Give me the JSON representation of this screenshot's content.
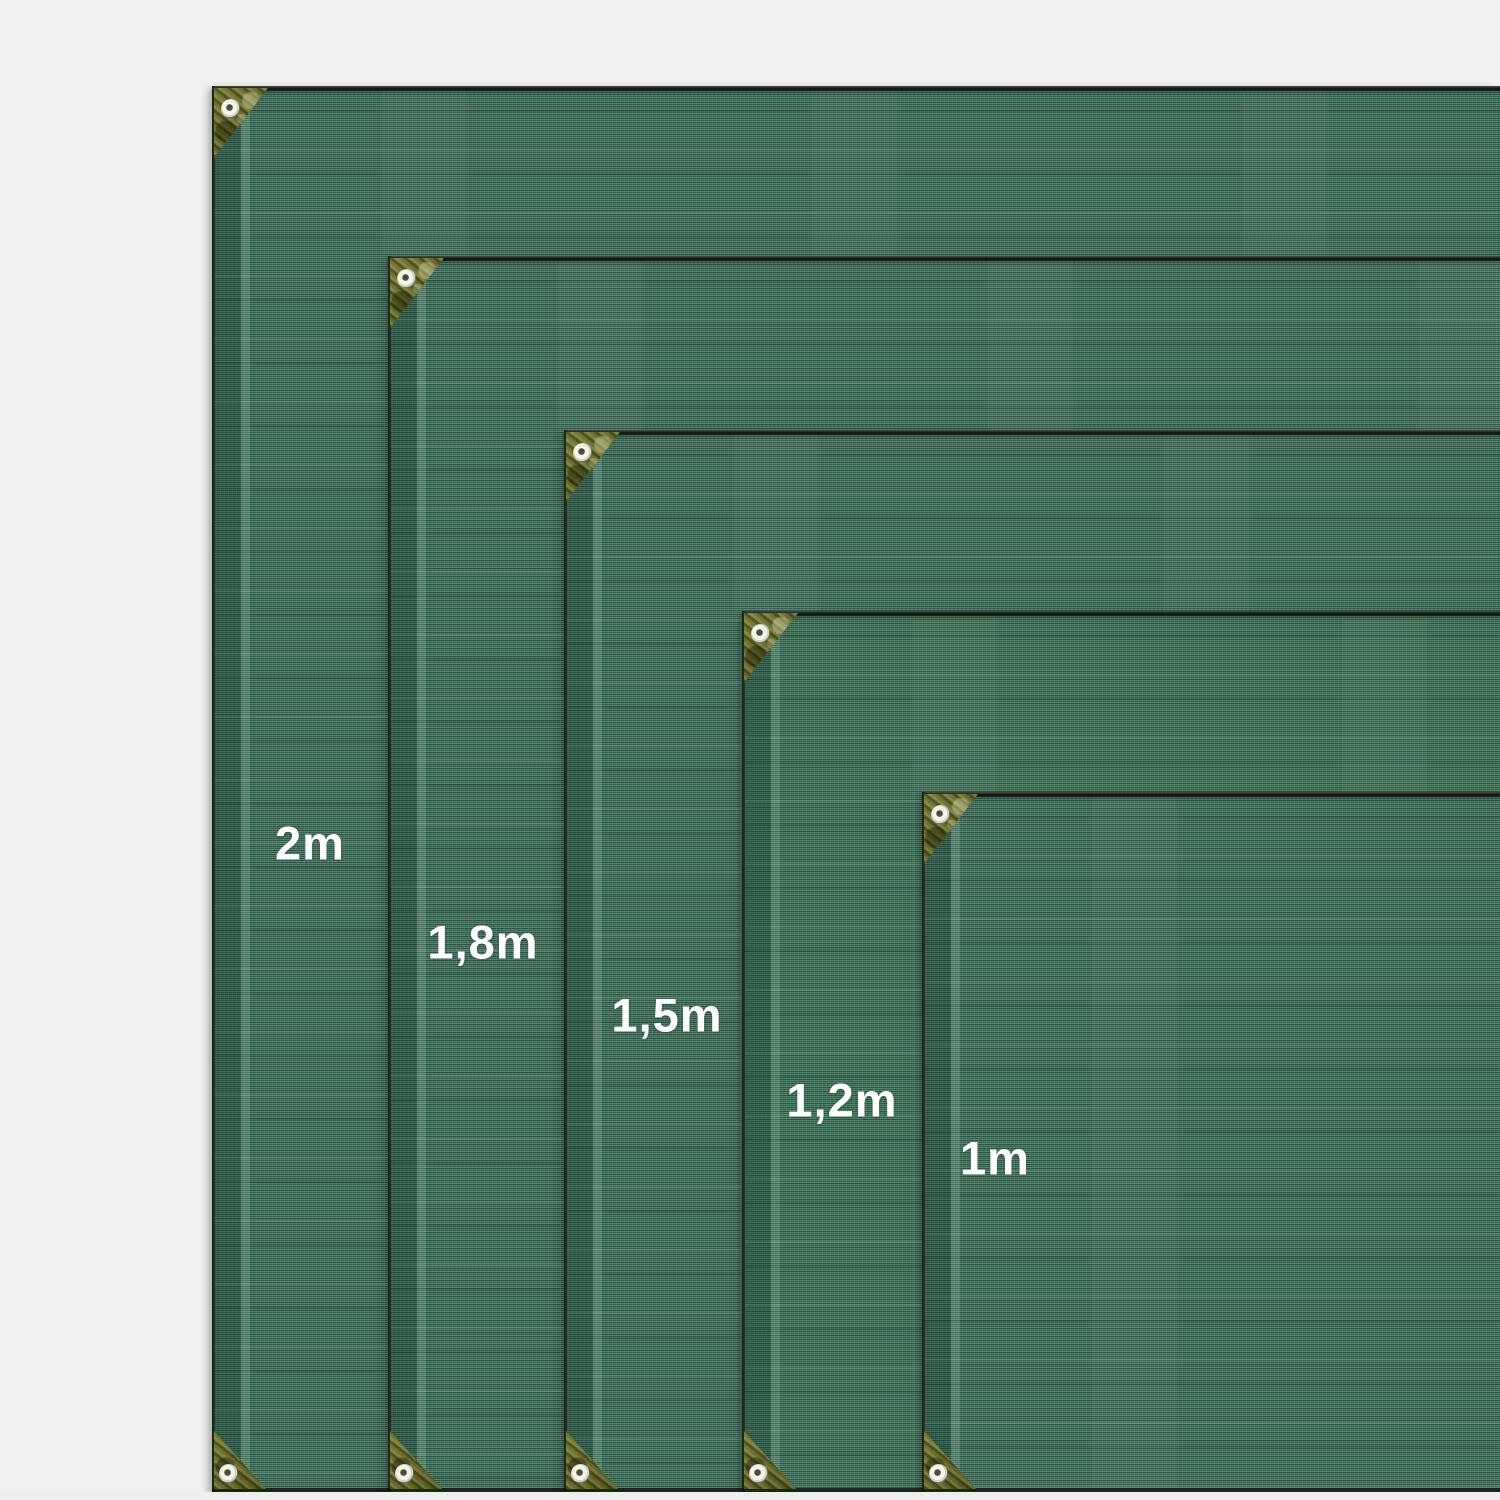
{
  "scene": {
    "description": "Size comparison of green privacy screen / shade netting panels with reinforced corners and grommets",
    "background_color": "#f1f1ef"
  },
  "sizes": [
    {
      "label": "2m"
    },
    {
      "label": "1,8m"
    },
    {
      "label": "1,5m"
    },
    {
      "label": "1,2m"
    },
    {
      "label": "1m"
    }
  ],
  "hardware": {
    "corner_patch": "olive reinforced corner patch",
    "grommet": "metal eyelet grommet"
  },
  "colors": {
    "fabric_base": "#3c6852",
    "fabric_rib_dark": "#2b5342",
    "fabric_rib_light": "#55856c",
    "hem_shade": "#33604c",
    "hem_stripe": "#5e8a73",
    "edge_dark": "#161d17",
    "corner_patch_olive": "#6b6e33",
    "eyelet_ring": "#f2f2ea",
    "label_text": "#ffffff"
  }
}
